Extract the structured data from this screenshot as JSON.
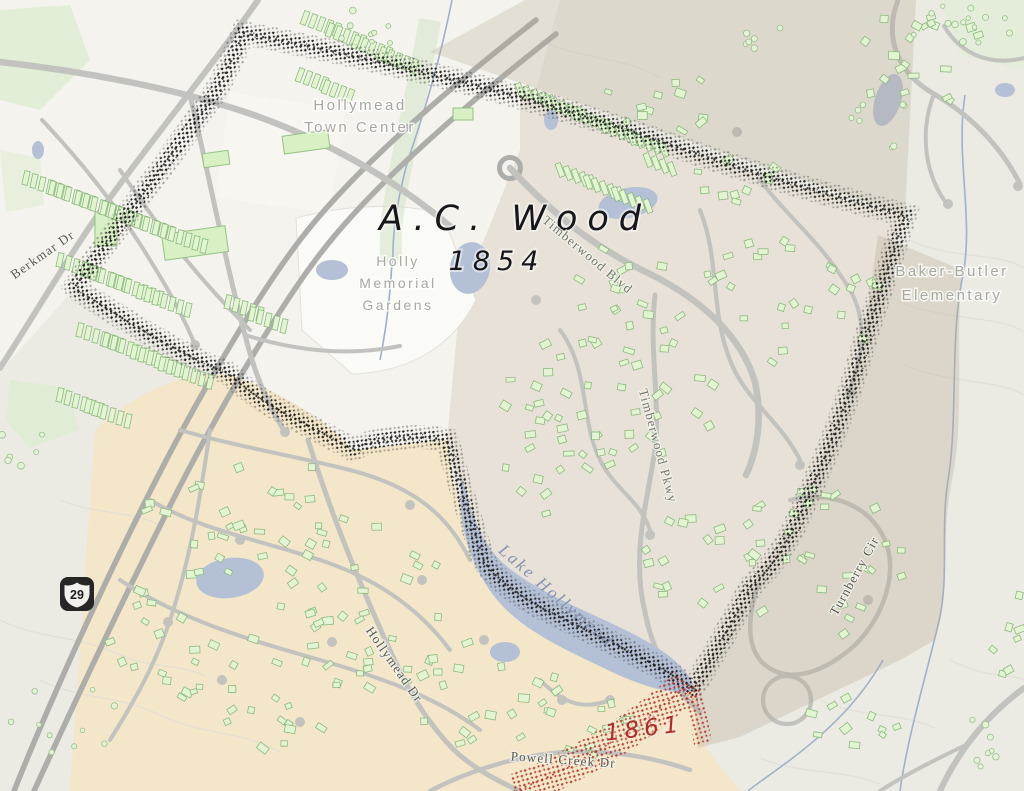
{
  "map": {
    "parcels": {
      "owner_label": "A.C. Wood",
      "year_label": "1854",
      "adjacent_year_label": "1861"
    },
    "places": {
      "hollymead_town_center": [
        "Hollymead",
        "Town Center"
      ],
      "holly_memorial_gardens": [
        "Holly",
        "Memorial",
        "Gardens"
      ],
      "baker_butler_elementary": [
        "Baker-Butler",
        "Elementary"
      ]
    },
    "roads": {
      "berkmar_dr": "Berkmar Dr",
      "timberwood_blvd": "Timberwood Blvd",
      "timberwood_pkwy": "Timberwood Pkwy",
      "turnberry_cir": "Turnberry Cir",
      "hollymead_dr": "Hollymead Dr",
      "powell_creek_dr": "Powell Creek Dr",
      "route_shield_number": "29"
    },
    "water": {
      "lake_label": "Lake Hollymead"
    },
    "colors": {
      "parcel_boundary_ink": "#1d1d1b",
      "adjacent_boundary_red": "#b03428",
      "water_fill": "#b4c0d5",
      "subdivision_tan": "#f3e6c9",
      "overlay_taupe": "#b5a88d",
      "building_green": "#e3f4d3",
      "road_gray": "#c2c2bf",
      "poi_label_gray": "#a7a79f"
    }
  }
}
